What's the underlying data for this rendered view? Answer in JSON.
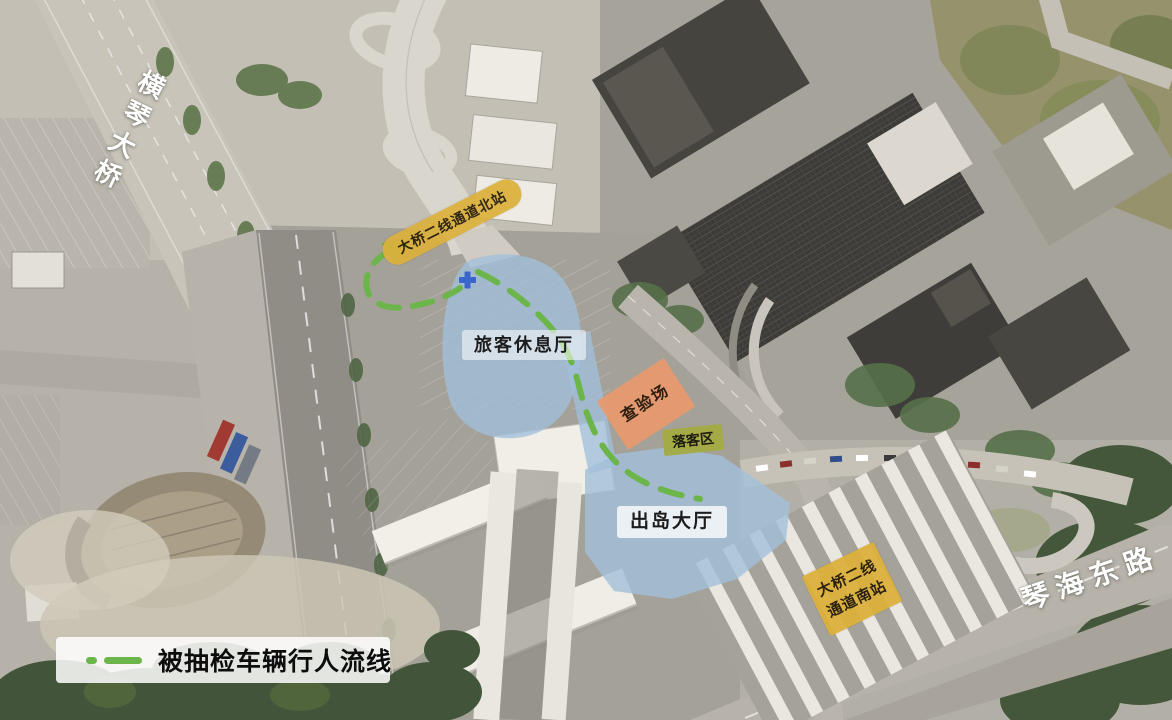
{
  "labels": {
    "hengqin_bridge": "横琴大桥",
    "north_station": "大桥二线通道北站",
    "rest_hall": "旅客休息厅",
    "inspection_area": "查验场",
    "dropoff_area": "落客区",
    "exit_hall": "出岛大厅",
    "south_station_line1": "大桥二线",
    "south_station_line2": "通道南站",
    "qinhai_east_road": "琴海东路"
  },
  "legend": {
    "flow_line_label": "被抽检车辆行人流线"
  },
  "markers": {
    "location_cross": "blue-plus-marker",
    "flow_arrow": "green-arrow-northeast"
  },
  "colors": {
    "flow_line_green": "#6cb54a",
    "zone_blue": "#a2bfda",
    "inspection_orange": "#e9996c",
    "station_label_yellow": "#dcb13c",
    "dropoff_label_olive": "#a4ab3f",
    "marker_blue": "#3a66cc"
  }
}
